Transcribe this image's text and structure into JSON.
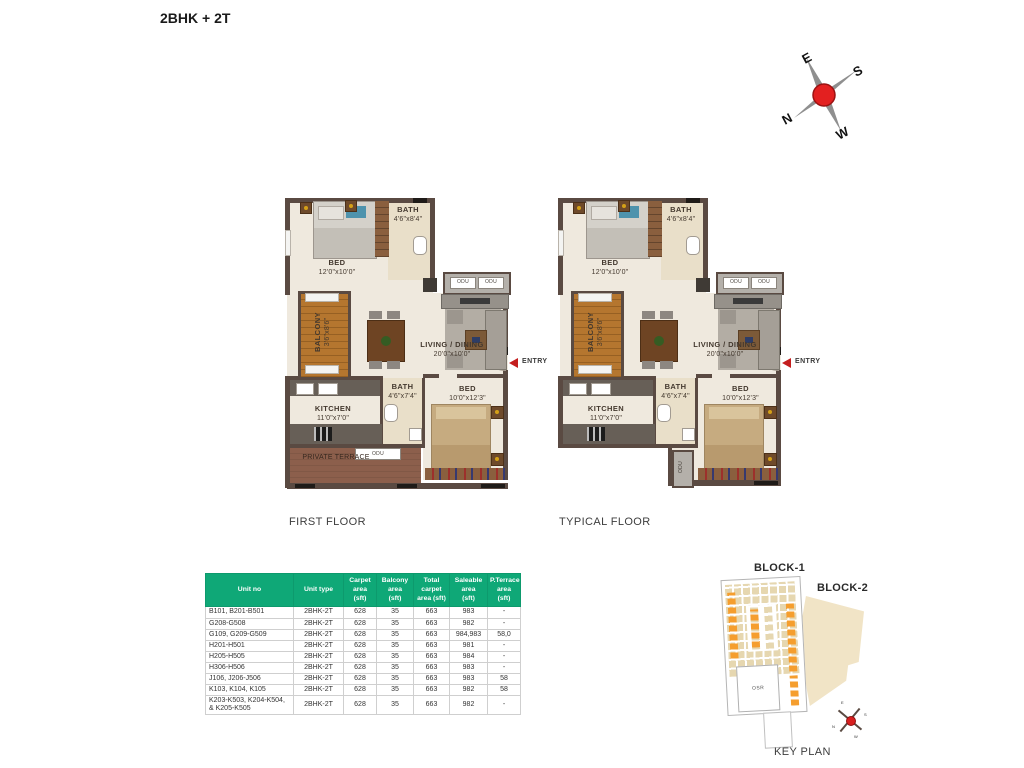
{
  "title": "2BHK + 2T",
  "compass": {
    "e": "E",
    "s": "S",
    "n": "N",
    "w": "W"
  },
  "plans": {
    "first": {
      "caption": "FIRST FLOOR",
      "bed1": {
        "name": "BED",
        "dim": "12'0\"x10'0\""
      },
      "bath1": {
        "name": "BATH",
        "dim": "4'6\"x8'4\""
      },
      "odu_a": "ODU",
      "odu_b": "ODU",
      "balcony": {
        "name": "BALCONY",
        "dim": "3'6\"x8'6\""
      },
      "living": {
        "name": "LIVING / DINING",
        "dim": "20'0\"x10'0\""
      },
      "entry": "ENTRY",
      "kitchen": {
        "name": "KITCHEN",
        "dim": "11'0\"x7'0\""
      },
      "bath2": {
        "name": "BATH",
        "dim": "4'6\"x7'4\""
      },
      "bed2": {
        "name": "BED",
        "dim": "10'0\"x12'3\""
      },
      "terrace": {
        "name": "PRIVATE TERRACE",
        "odu": "ODU"
      }
    },
    "typical": {
      "caption": "TYPICAL FLOOR",
      "bed1": {
        "name": "BED",
        "dim": "12'0\"x10'0\""
      },
      "bath1": {
        "name": "BATH",
        "dim": "4'6\"x8'4\""
      },
      "odu_a": "ODU",
      "odu_b": "ODU",
      "balcony": {
        "name": "BALCONY",
        "dim": "3'6\"x8'6\""
      },
      "living": {
        "name": "LIVING / DINING",
        "dim": "20'0\"x10'0\""
      },
      "entry": "ENTRY",
      "kitchen": {
        "name": "KITCHEN",
        "dim": "11'0\"x7'0\""
      },
      "bath2": {
        "name": "BATH",
        "dim": "4'6\"x7'4\""
      },
      "bed2": {
        "name": "BED",
        "dim": "10'0\"x12'3\""
      },
      "odu_side": "ODU"
    }
  },
  "table": {
    "header_bg": "#0FA877",
    "headers": [
      "Unit no",
      "Unit type",
      "Carpet\narea\n(sft)",
      "Balcony\narea\n(sft)",
      "Total\ncarpet\narea (sft)",
      "Saleable\narea\n(sft)",
      "P.Terrace\narea\n(sft)"
    ],
    "rows": [
      [
        "B101, B201-B501",
        "2BHK-2T",
        "628",
        "35",
        "663",
        "983",
        "-"
      ],
      [
        "G208-G508",
        "2BHK-2T",
        "628",
        "35",
        "663",
        "982",
        "-"
      ],
      [
        "G109, G209-G509",
        "2BHK-2T",
        "628",
        "35",
        "663",
        "984,983",
        "58,0"
      ],
      [
        "H201-H501",
        "2BHK-2T",
        "628",
        "35",
        "663",
        "981",
        "-"
      ],
      [
        "H205-H505",
        "2BHK-2T",
        "628",
        "35",
        "663",
        "984",
        "-"
      ],
      [
        "H306-H506",
        "2BHK-2T",
        "628",
        "35",
        "663",
        "983",
        "-"
      ],
      [
        "J106, J206-J506",
        "2BHK-2T",
        "628",
        "35",
        "663",
        "983",
        "58"
      ],
      [
        "K103, K104, K105",
        "2BHK-2T",
        "628",
        "35",
        "663",
        "982",
        "58"
      ],
      [
        "K203-K503, K204-K504, & K205-K505",
        "2BHK-2T",
        "628",
        "35",
        "663",
        "982",
        "-"
      ]
    ]
  },
  "keyplan": {
    "block1": "BLOCK-1",
    "block2": "BLOCK-2",
    "osr": "OSR",
    "caption": "KEY PLAN",
    "compass": {
      "n": "N",
      "e": "E",
      "s": "S",
      "w": "W"
    }
  },
  "colors": {
    "accent_orange": "#F59E2E",
    "wall_brown": "#5A4A42",
    "entry_red": "#C41E1E"
  }
}
